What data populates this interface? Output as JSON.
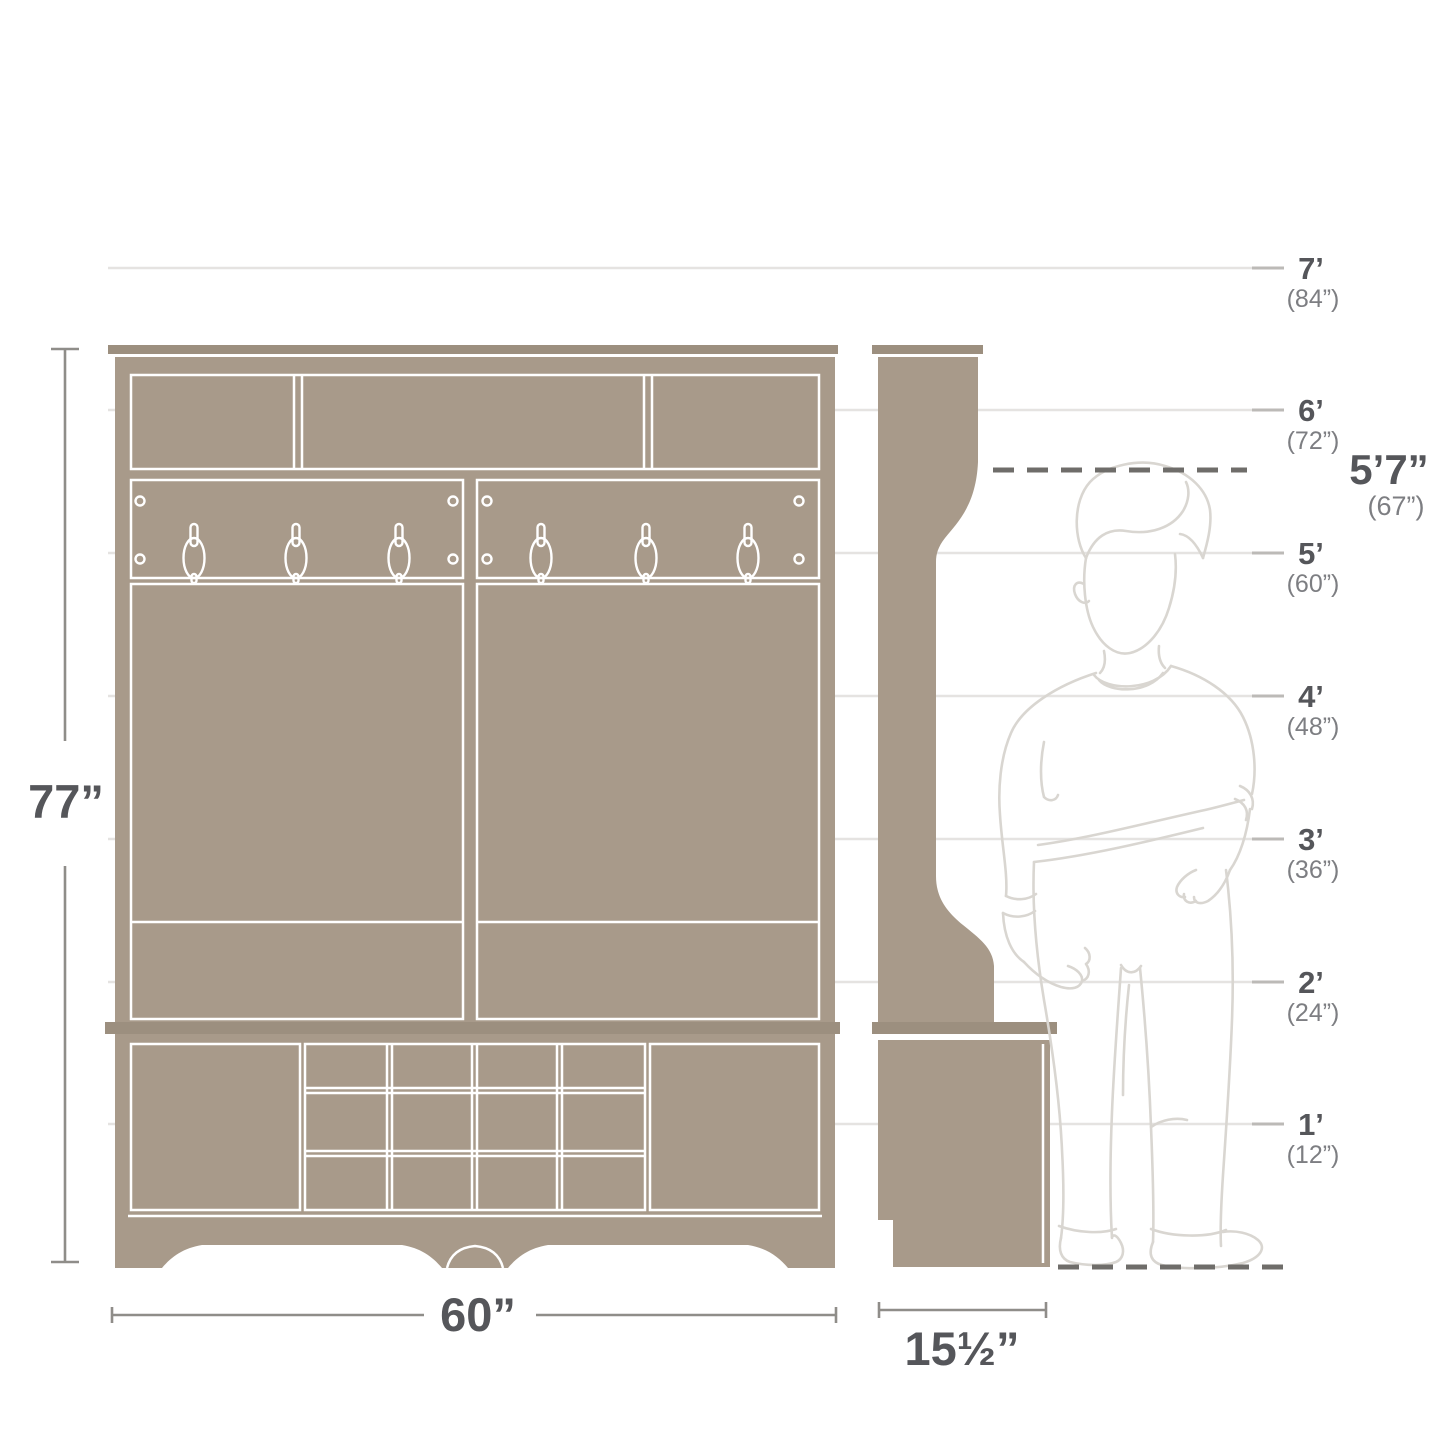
{
  "diagram_type": "furniture-dimension-diagram",
  "measurements": {
    "height_label": "77”",
    "width_label": "60”",
    "depth_label": "15½”"
  },
  "person": {
    "height_feet": "5’7”",
    "height_inches": "(67”)"
  },
  "height_scale": [
    {
      "feet": "7’",
      "inches": "(84”)"
    },
    {
      "feet": "6’",
      "inches": "(72”)"
    },
    {
      "feet": "5’",
      "inches": "(60”)"
    },
    {
      "feet": "4’",
      "inches": "(48”)"
    },
    {
      "feet": "3’",
      "inches": "(36”)"
    },
    {
      "feet": "2’",
      "inches": "(24”)"
    },
    {
      "feet": "1’",
      "inches": "(12”)"
    }
  ],
  "colors": {
    "furniture_fill": "#a89a8a",
    "furniture_cap": "#9c8f7f",
    "gridline": "#e5e3e1",
    "grid_tick": "#bcbab7",
    "dashed_line": "#6f6d6a",
    "dimension_line": "#8f8d89",
    "label_primary": "#55565a",
    "label_secondary": "#7d7e82",
    "person_outline": "#d9d6d1"
  }
}
